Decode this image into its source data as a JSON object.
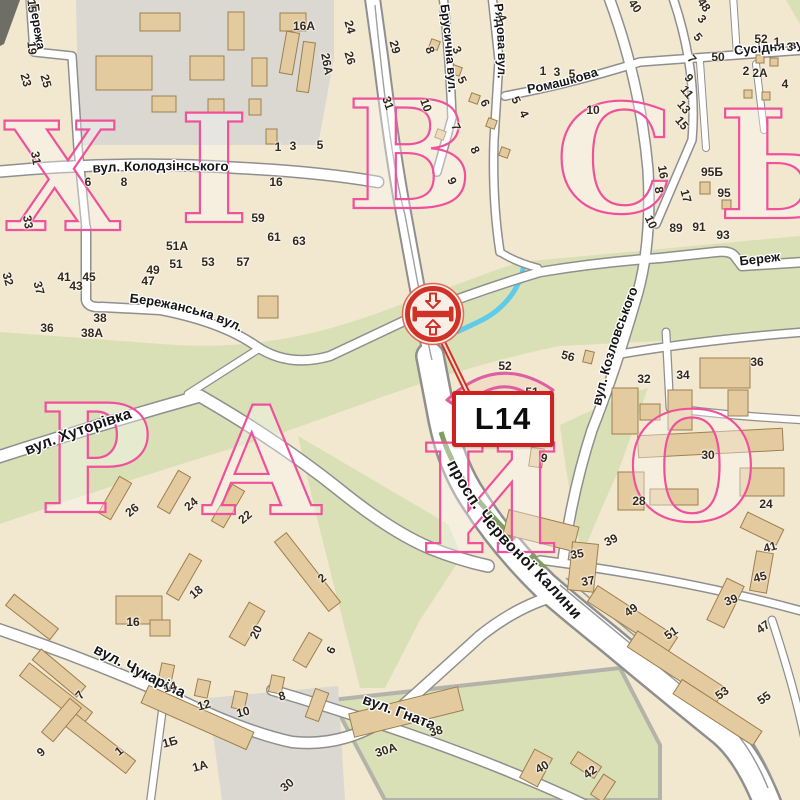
{
  "map": {
    "badge": {
      "code": "L14"
    },
    "marker": {
      "icon": "billboard-two-sided-arrows-icon",
      "color": "#cf3327"
    },
    "district": {
      "row1_visible": "ХІВСЬ",
      "row2_visible": "РАЙО",
      "letters": [
        {
          "t": "Х",
          "x": 62,
          "y": 230
        },
        {
          "t": "І",
          "x": 214,
          "y": 222
        },
        {
          "t": "В",
          "x": 410,
          "y": 208
        },
        {
          "t": "С",
          "x": 615,
          "y": 212
        },
        {
          "t": "Ь",
          "x": 780,
          "y": 218
        },
        {
          "t": "Р",
          "x": 95,
          "y": 512
        },
        {
          "t": "А",
          "x": 262,
          "y": 514
        },
        {
          "t": "Й",
          "x": 490,
          "y": 552
        },
        {
          "t": "О",
          "x": 692,
          "y": 520
        }
      ]
    },
    "streets": {
      "berezha_top": "Бережа",
      "kolodzinskoho": "вул. Колодзінського",
      "brusnychna": "Брусична вул.",
      "riadova": "Рядова вул.",
      "romashkova": "Ромашкова",
      "susidnia": "Сусідня вул.",
      "kozlovskoho": "вул. Козловського",
      "berezhanska": "Бережанська вул.",
      "berezh_right": "Береж",
      "khutorivka": "вул. Хуторівка",
      "chervonoi_kalyny": "просп. Червоної Калини",
      "chukarina": "вул. Чукаріна",
      "hnata": "вул. Гната"
    },
    "house_numbers": [
      {
        "t": "15",
        "x": 32,
        "y": 6,
        "r": 85
      },
      {
        "t": "19",
        "x": 32,
        "y": 48,
        "r": 85
      },
      {
        "t": "23",
        "x": 26,
        "y": 80,
        "r": 75
      },
      {
        "t": "25",
        "x": 46,
        "y": 81,
        "r": 75
      },
      {
        "t": "31",
        "x": 36,
        "y": 158,
        "r": 80
      },
      {
        "t": "33",
        "x": 28,
        "y": 222,
        "r": 80
      },
      {
        "t": "16А",
        "x": 304,
        "y": 26,
        "r": 0
      },
      {
        "t": "24",
        "x": 350,
        "y": 27,
        "r": 75
      },
      {
        "t": "26",
        "x": 350,
        "y": 58,
        "r": 75
      },
      {
        "t": "26А",
        "x": 327,
        "y": 64,
        "r": 80
      },
      {
        "t": "31",
        "x": 388,
        "y": 103,
        "r": 70
      },
      {
        "t": "1",
        "x": 278,
        "y": 147,
        "r": 0
      },
      {
        "t": "3",
        "x": 293,
        "y": 146,
        "r": 0
      },
      {
        "t": "5",
        "x": 320,
        "y": 145,
        "r": 0
      },
      {
        "t": "6",
        "x": 88,
        "y": 182,
        "r": 0
      },
      {
        "t": "8",
        "x": 124,
        "y": 182,
        "r": 0
      },
      {
        "t": "16",
        "x": 276,
        "y": 182,
        "r": 0
      },
      {
        "t": "59",
        "x": 258,
        "y": 218,
        "r": 0
      },
      {
        "t": "61",
        "x": 274,
        "y": 237,
        "r": 0
      },
      {
        "t": "63",
        "x": 299,
        "y": 241,
        "r": 0
      },
      {
        "t": "51А",
        "x": 177,
        "y": 246,
        "r": 0
      },
      {
        "t": "49",
        "x": 153,
        "y": 270,
        "r": 0
      },
      {
        "t": "51",
        "x": 176,
        "y": 264,
        "r": 0
      },
      {
        "t": "53",
        "x": 208,
        "y": 262,
        "r": 0
      },
      {
        "t": "57",
        "x": 243,
        "y": 262,
        "r": 0
      },
      {
        "t": "47",
        "x": 148,
        "y": 281,
        "r": 0
      },
      {
        "t": "45",
        "x": 89,
        "y": 277,
        "r": 0
      },
      {
        "t": "43",
        "x": 76,
        "y": 286,
        "r": 0
      },
      {
        "t": "41",
        "x": 64,
        "y": 277,
        "r": 0
      },
      {
        "t": "37",
        "x": 39,
        "y": 288,
        "r": 75
      },
      {
        "t": "32",
        "x": 8,
        "y": 279,
        "r": 75
      },
      {
        "t": "36",
        "x": 47,
        "y": 328,
        "r": 0
      },
      {
        "t": "38",
        "x": 100,
        "y": 318,
        "r": 0
      },
      {
        "t": "38А",
        "x": 92,
        "y": 333,
        "r": 0
      },
      {
        "t": "29",
        "x": 395,
        "y": 47,
        "r": 75
      },
      {
        "t": "8",
        "x": 430,
        "y": 50,
        "r": 70
      },
      {
        "t": "3",
        "x": 457,
        "y": 50,
        "r": 65
      },
      {
        "t": "5",
        "x": 462,
        "y": 80,
        "r": 65
      },
      {
        "t": "10",
        "x": 426,
        "y": 105,
        "r": 70
      },
      {
        "t": "7",
        "x": 456,
        "y": 127,
        "r": 65
      },
      {
        "t": "8",
        "x": 475,
        "y": 150,
        "r": 65
      },
      {
        "t": "9",
        "x": 452,
        "y": 181,
        "r": 65
      },
      {
        "t": "4",
        "x": 502,
        "y": 18,
        "r": 65
      },
      {
        "t": "6",
        "x": 485,
        "y": 103,
        "r": 65
      },
      {
        "t": "5",
        "x": 516,
        "y": 100,
        "r": 65
      },
      {
        "t": "4",
        "x": 524,
        "y": 114,
        "r": 65
      },
      {
        "t": "1",
        "x": 543,
        "y": 71,
        "r": 0
      },
      {
        "t": "3",
        "x": 557,
        "y": 72,
        "r": 0
      },
      {
        "t": "5",
        "x": 572,
        "y": 74,
        "r": 0
      },
      {
        "t": "10",
        "x": 593,
        "y": 110,
        "r": 0
      },
      {
        "t": "40",
        "x": 635,
        "y": 6,
        "r": 55
      },
      {
        "t": "48",
        "x": 704,
        "y": 5,
        "r": 55
      },
      {
        "t": "3",
        "x": 702,
        "y": 19,
        "r": 50
      },
      {
        "t": "5",
        "x": 698,
        "y": 37,
        "r": 50
      },
      {
        "t": "7",
        "x": 692,
        "y": 59,
        "r": 50
      },
      {
        "t": "9",
        "x": 689,
        "y": 78,
        "r": 50
      },
      {
        "t": "11",
        "x": 687,
        "y": 92,
        "r": 50
      },
      {
        "t": "13",
        "x": 684,
        "y": 107,
        "r": 50
      },
      {
        "t": "15",
        "x": 682,
        "y": 123,
        "r": 50
      },
      {
        "t": "50",
        "x": 718,
        "y": 57,
        "r": 0
      },
      {
        "t": "52",
        "x": 761,
        "y": 39,
        "r": 0
      },
      {
        "t": "1",
        "x": 777,
        "y": 42,
        "r": 0
      },
      {
        "t": "3",
        "x": 790,
        "y": 47,
        "r": 0
      },
      {
        "t": "2",
        "x": 746,
        "y": 71,
        "r": 0
      },
      {
        "t": "2А",
        "x": 760,
        "y": 73,
        "r": 0
      },
      {
        "t": "4",
        "x": 785,
        "y": 84,
        "r": 0
      },
      {
        "t": "16",
        "x": 663,
        "y": 172,
        "r": 80
      },
      {
        "t": "8",
        "x": 659,
        "y": 190,
        "r": 80
      },
      {
        "t": "17",
        "x": 686,
        "y": 196,
        "r": 75
      },
      {
        "t": "95Б",
        "x": 712,
        "y": 172,
        "r": 0
      },
      {
        "t": "95",
        "x": 724,
        "y": 193,
        "r": 0
      },
      {
        "t": "10",
        "x": 651,
        "y": 222,
        "r": 65
      },
      {
        "t": "89",
        "x": 676,
        "y": 228,
        "r": 0
      },
      {
        "t": "91",
        "x": 699,
        "y": 227,
        "r": 0
      },
      {
        "t": "93",
        "x": 723,
        "y": 235,
        "r": 0
      },
      {
        "t": "56",
        "x": 568,
        "y": 356,
        "r": 15
      },
      {
        "t": "52",
        "x": 505,
        "y": 366,
        "r": 0
      },
      {
        "t": "51",
        "x": 532,
        "y": 392,
        "r": 0
      },
      {
        "t": "9",
        "x": 544,
        "y": 458,
        "r": 15
      },
      {
        "t": "32",
        "x": 644,
        "y": 379,
        "r": 0
      },
      {
        "t": "34",
        "x": 683,
        "y": 375,
        "r": 0
      },
      {
        "t": "36",
        "x": 757,
        "y": 362,
        "r": 0
      },
      {
        "t": "30",
        "x": 708,
        "y": 455,
        "r": 0
      },
      {
        "t": "28",
        "x": 639,
        "y": 501,
        "r": 0
      },
      {
        "t": "24",
        "x": 766,
        "y": 504,
        "r": 0
      },
      {
        "t": "39",
        "x": 611,
        "y": 540,
        "r": -25
      },
      {
        "t": "35",
        "x": 577,
        "y": 554,
        "r": -10
      },
      {
        "t": "37",
        "x": 588,
        "y": 581,
        "r": -10
      },
      {
        "t": "41",
        "x": 770,
        "y": 547,
        "r": -15
      },
      {
        "t": "45",
        "x": 760,
        "y": 577,
        "r": -15
      },
      {
        "t": "39",
        "x": 731,
        "y": 600,
        "r": -20
      },
      {
        "t": "47",
        "x": 763,
        "y": 627,
        "r": -35
      },
      {
        "t": "49",
        "x": 631,
        "y": 610,
        "r": -35
      },
      {
        "t": "51",
        "x": 671,
        "y": 633,
        "r": -35
      },
      {
        "t": "53",
        "x": 722,
        "y": 693,
        "r": -35
      },
      {
        "t": "55",
        "x": 764,
        "y": 698,
        "r": -35
      },
      {
        "t": "42",
        "x": 590,
        "y": 772,
        "r": -35
      },
      {
        "t": "40",
        "x": 542,
        "y": 767,
        "r": -30
      },
      {
        "t": "26",
        "x": 132,
        "y": 510,
        "r": -40
      },
      {
        "t": "24",
        "x": 191,
        "y": 504,
        "r": -40
      },
      {
        "t": "22",
        "x": 245,
        "y": 517,
        "r": -40
      },
      {
        "t": "18",
        "x": 196,
        "y": 592,
        "r": -40
      },
      {
        "t": "2",
        "x": 322,
        "y": 578,
        "r": -40
      },
      {
        "t": "16",
        "x": 133,
        "y": 622,
        "r": 0
      },
      {
        "t": "20",
        "x": 256,
        "y": 632,
        "r": -65
      },
      {
        "t": "6",
        "x": 331,
        "y": 650,
        "r": -65
      },
      {
        "t": "14",
        "x": 170,
        "y": 687,
        "r": -15
      },
      {
        "t": "12",
        "x": 204,
        "y": 705,
        "r": -15
      },
      {
        "t": "10",
        "x": 243,
        "y": 712,
        "r": -15
      },
      {
        "t": "8",
        "x": 282,
        "y": 696,
        "r": -15
      },
      {
        "t": "7",
        "x": 80,
        "y": 695,
        "r": -50
      },
      {
        "t": "9",
        "x": 41,
        "y": 752,
        "r": -40
      },
      {
        "t": "1",
        "x": 119,
        "y": 751,
        "r": -40
      },
      {
        "t": "1Б",
        "x": 170,
        "y": 742,
        "r": -15
      },
      {
        "t": "1А",
        "x": 200,
        "y": 766,
        "r": -15
      },
      {
        "t": "30",
        "x": 287,
        "y": 785,
        "r": -40
      },
      {
        "t": "38",
        "x": 436,
        "y": 731,
        "r": -15
      },
      {
        "t": "30А",
        "x": 386,
        "y": 750,
        "r": -18
      }
    ],
    "colors": {
      "land": "#f2e7cf",
      "building_fill": "#e4cb9f",
      "building_stroke": "#9c7f4e",
      "green_area": "#d9e0b6",
      "industrial_area": "#dbd8d2",
      "road_fill": "#ffffff",
      "road_casing": "#8f8f8f",
      "water": "#5ecbe9",
      "district_letters": "#f0519b",
      "marker_red": "#cf3327",
      "badge_border": "#cc2222"
    }
  }
}
